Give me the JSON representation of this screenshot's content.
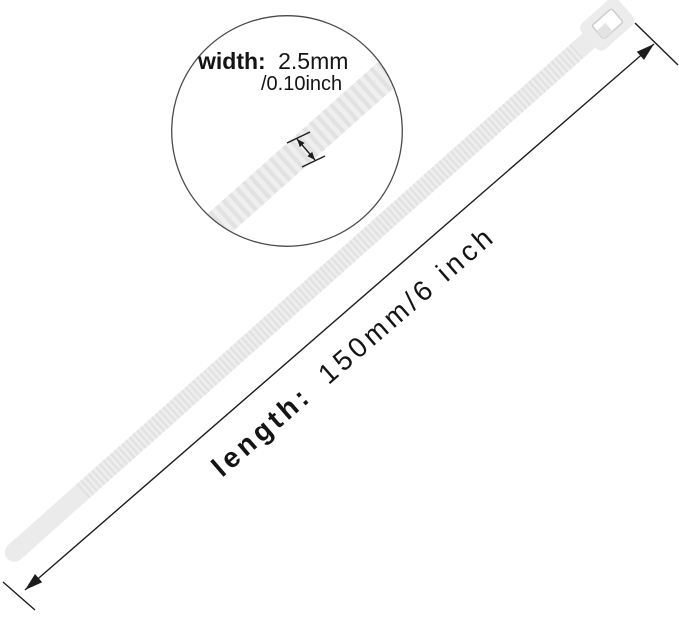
{
  "figure": {
    "type": "product dimension diagram",
    "subject": "white nylon cable zip tie shown diagonally with a magnified width detail circle and a length dimension arrow",
    "background_color": "#ffffff",
    "tie_color": "#ebebeb",
    "tie_rib_color": "#e2e2e2",
    "annotation_color": "#1c1c1c"
  },
  "width_callout": {
    "label": "width:",
    "value": "2.5mm",
    "alt_value": "/0.10inch"
  },
  "length_dimension": {
    "label": "length:",
    "value": "150mm/6 inch"
  }
}
